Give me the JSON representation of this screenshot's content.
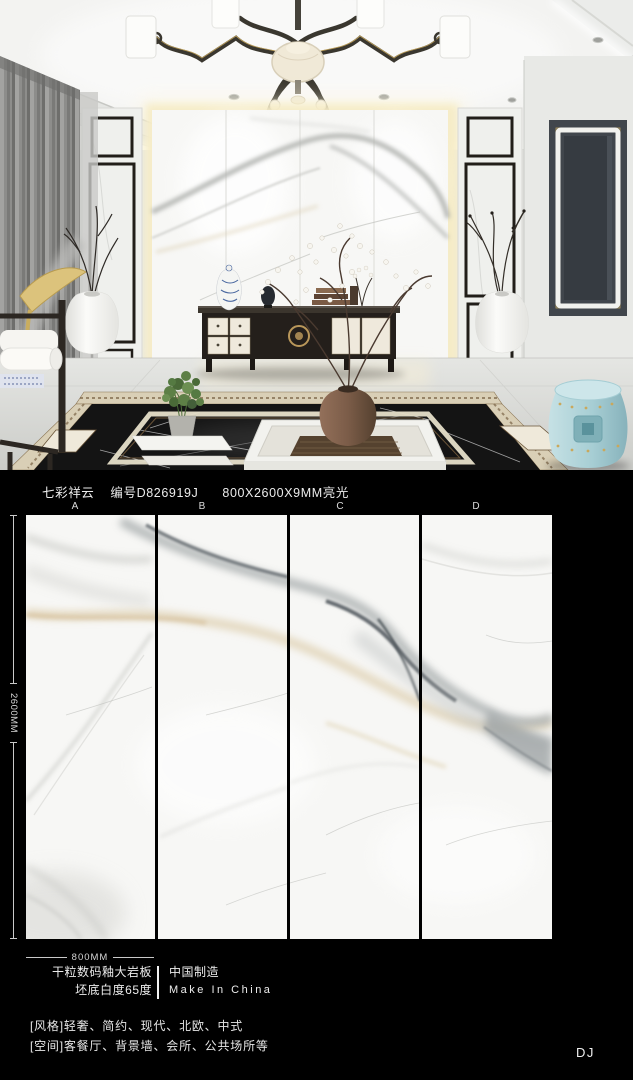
{
  "title": {
    "product_name": "七彩祥云",
    "product_code": "编号D826919J",
    "size_gloss": "800X2600X9MM亮光"
  },
  "slab_panel": {
    "labels": [
      "A",
      "B",
      "C",
      "D"
    ],
    "height_dim": "2600MM",
    "width_dim": "800MM"
  },
  "specs": {
    "material_line": "干粒数码釉大岩板",
    "whiteness_line": "坯底白度65度",
    "origin_cn": "中国制造",
    "origin_en": "Make In China"
  },
  "tags": {
    "style_line": "[风格]轻奢、简约、现代、北欧、中式",
    "space_line": "[空间]客餐厅、背景墙、会所、公共场所等"
  },
  "watermark": "DJ",
  "palette": {
    "page_bg": "#000000",
    "text": "#ececec",
    "slab_base": "#f7f7f5",
    "vein_gray": "#9aa0a2",
    "vein_beige": "#d8c49c",
    "cove_glow_warm": "#f6ecc6",
    "stool_blue": "#aed3d8",
    "gold_accent": "#c9a85c",
    "dark_panel": "#41464c",
    "black_marble_floor": "#141414"
  }
}
